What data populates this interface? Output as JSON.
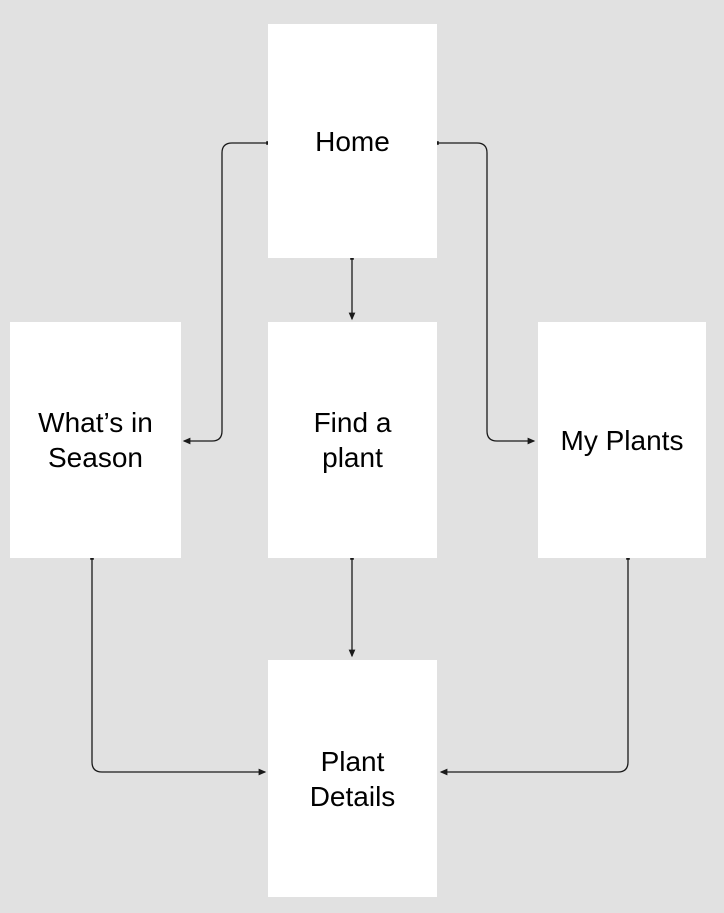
{
  "diagram": {
    "type": "flowchart",
    "nodes": {
      "home": {
        "label": "Home"
      },
      "whats_in_season": {
        "label": [
          "What’s in",
          "Season"
        ]
      },
      "find_a_plant": {
        "label": [
          "Find a",
          "plant"
        ]
      },
      "my_plants": {
        "label": "My Plants"
      },
      "plant_details": {
        "label": [
          "Plant",
          "Details"
        ]
      }
    },
    "edges": [
      {
        "from": "Home",
        "to": "Find a plant"
      },
      {
        "from": "Home",
        "to": "What’s in Season"
      },
      {
        "from": "Home",
        "to": "My Plants"
      },
      {
        "from": "Find a plant",
        "to": "Plant Details"
      },
      {
        "from": "What’s in Season",
        "to": "Plant Details"
      },
      {
        "from": "My Plants",
        "to": "Plant Details"
      }
    ]
  },
  "colors": {
    "background": "#e1e1e1",
    "node_fill": "#ffffff",
    "connector": "#1a1a1a",
    "text": "#000000"
  }
}
